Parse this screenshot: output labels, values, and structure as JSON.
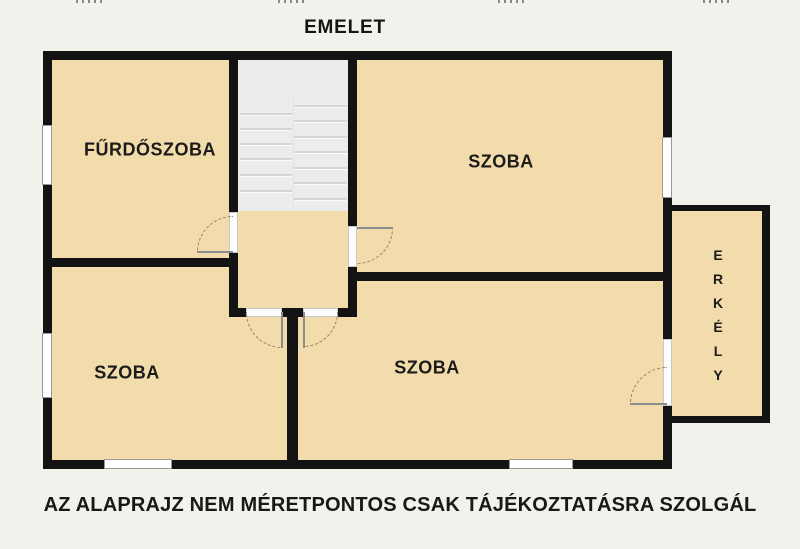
{
  "title": "EMELET",
  "disclaimer": "AZ ALAPRAJZ NEM MÉRETPONTOS CSAK TÁJÉKOZTATÁSRA SZOLGÁL",
  "rooms": [
    {
      "id": "bathroom",
      "label": "FŰRDŐSZOBA"
    },
    {
      "id": "room-top-right",
      "label": "SZOBA"
    },
    {
      "id": "room-bottom-left",
      "label": "SZOBA"
    },
    {
      "id": "room-bottom-right",
      "label": "SZOBA"
    },
    {
      "id": "balcony",
      "label": "ERKÉLY"
    }
  ],
  "features": {
    "staircase": "switchback staircase, two flights",
    "window_count": 5,
    "door_count": 5
  },
  "top_cropped_marks": [
    {
      "x": 76
    },
    {
      "x": 278
    },
    {
      "x": 498
    },
    {
      "x": 703
    }
  ],
  "colors": {
    "background": "#f3f1ec",
    "wall": "#131313",
    "room_fill": "#f2dcab",
    "stairs_fill": "#ececee",
    "window": "#ffffff",
    "door_arc": "#97845f",
    "text": "#181818"
  }
}
